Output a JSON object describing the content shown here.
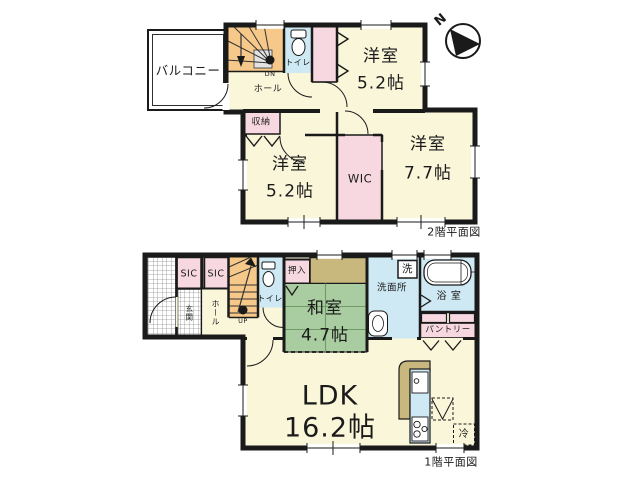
{
  "compass": {
    "north_label": "N"
  },
  "floor2": {
    "caption": "2階平面図",
    "balcony_label": "バルコニー",
    "hall_label": "ホール",
    "stairs_label": "DN",
    "toilet_label": "トイレ",
    "closet_label": "収納",
    "wic_label": "WIC",
    "bedroom_top": {
      "name": "洋室",
      "size": "5.2帖"
    },
    "bedroom_left": {
      "name": "洋室",
      "size": "5.2帖"
    },
    "bedroom_right": {
      "name": "洋室",
      "size": "7.7帖"
    }
  },
  "floor1": {
    "caption": "1階平面図",
    "entrance_label": "玄関",
    "shoe_closet_left_label": "SIC",
    "shoe_closet_right_label": "SIC",
    "hall_label": "ホール",
    "stairs_label": "UP",
    "toilet_label": "トイレ",
    "futon_closet_label": "押入",
    "japanese_room": {
      "name": "和室",
      "size": "4.7帖"
    },
    "washroom_label": "洗面所",
    "washer_label": "洗",
    "bathroom_label": "浴 室",
    "pantry_label": "パントリー",
    "ldk": {
      "name": "LDK",
      "size": "16.2帖"
    },
    "refrigerator_label": "冷"
  },
  "colors": {
    "wall": "#1a1a1a",
    "floor_cream": "#FAF6DA",
    "closet_pink": "#F7D8E1",
    "water_blue": "#CEE9F3",
    "stairs_orange": "#F6C98B",
    "tatami_green": "#A9CCA0",
    "counter_tan": "#C8B87E"
  }
}
